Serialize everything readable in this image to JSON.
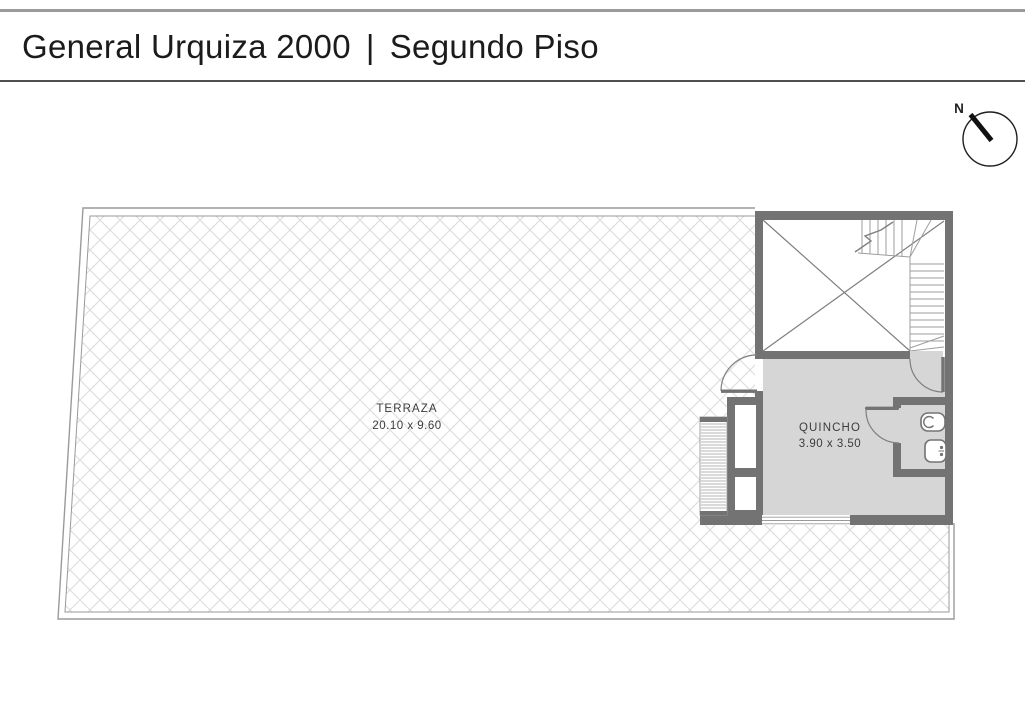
{
  "header": {
    "project": "General Urquiza 2000",
    "separator": "|",
    "floor": "Segundo Piso"
  },
  "compass": {
    "label": "N"
  },
  "floor_plan": {
    "terraza": {
      "name": "TERRAZA",
      "dimensions": "20.10 x 9.60"
    },
    "quincho": {
      "name": "QUINCHO",
      "dimensions": "3.90 x 3.50"
    }
  },
  "colors": {
    "wall": "#737373",
    "room_fill": "#d6d6d6",
    "hatch_line": "#dcdcdc",
    "thin_outline": "#9a9a9a",
    "stair_line": "#9e9e9e",
    "detail_line": "#7f7f7f",
    "text": "#3d3d3d",
    "title_text": "#1b1b1b"
  }
}
